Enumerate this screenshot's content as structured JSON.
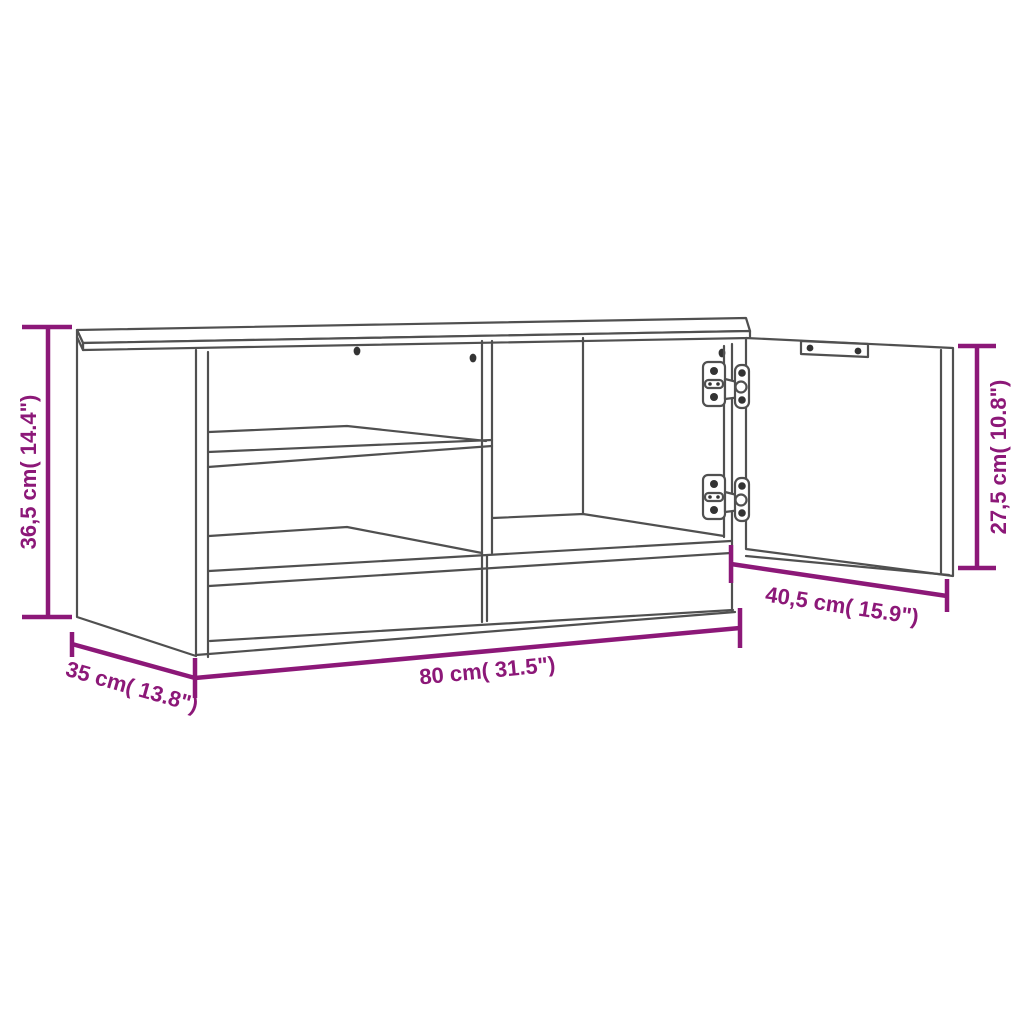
{
  "image": {
    "type": "product-dimension-diagram",
    "product": "TV cabinet with open hinged door, interior shelf and center divider",
    "colors": {
      "dimension_lines": "#8C1878",
      "drawing_lines": "#505050",
      "background": "#FFFFFF"
    },
    "dimensions": {
      "overall_height": {
        "label": "36,5 cm( 14.4\")"
      },
      "overall_width": {
        "label": "80 cm( 31.5\")"
      },
      "overall_depth": {
        "label": "35 cm( 13.8\")"
      },
      "door_width": {
        "label": "40,5 cm( 15.9\")"
      },
      "door_height": {
        "label": "27,5 cm( 10.8\")"
      }
    }
  }
}
